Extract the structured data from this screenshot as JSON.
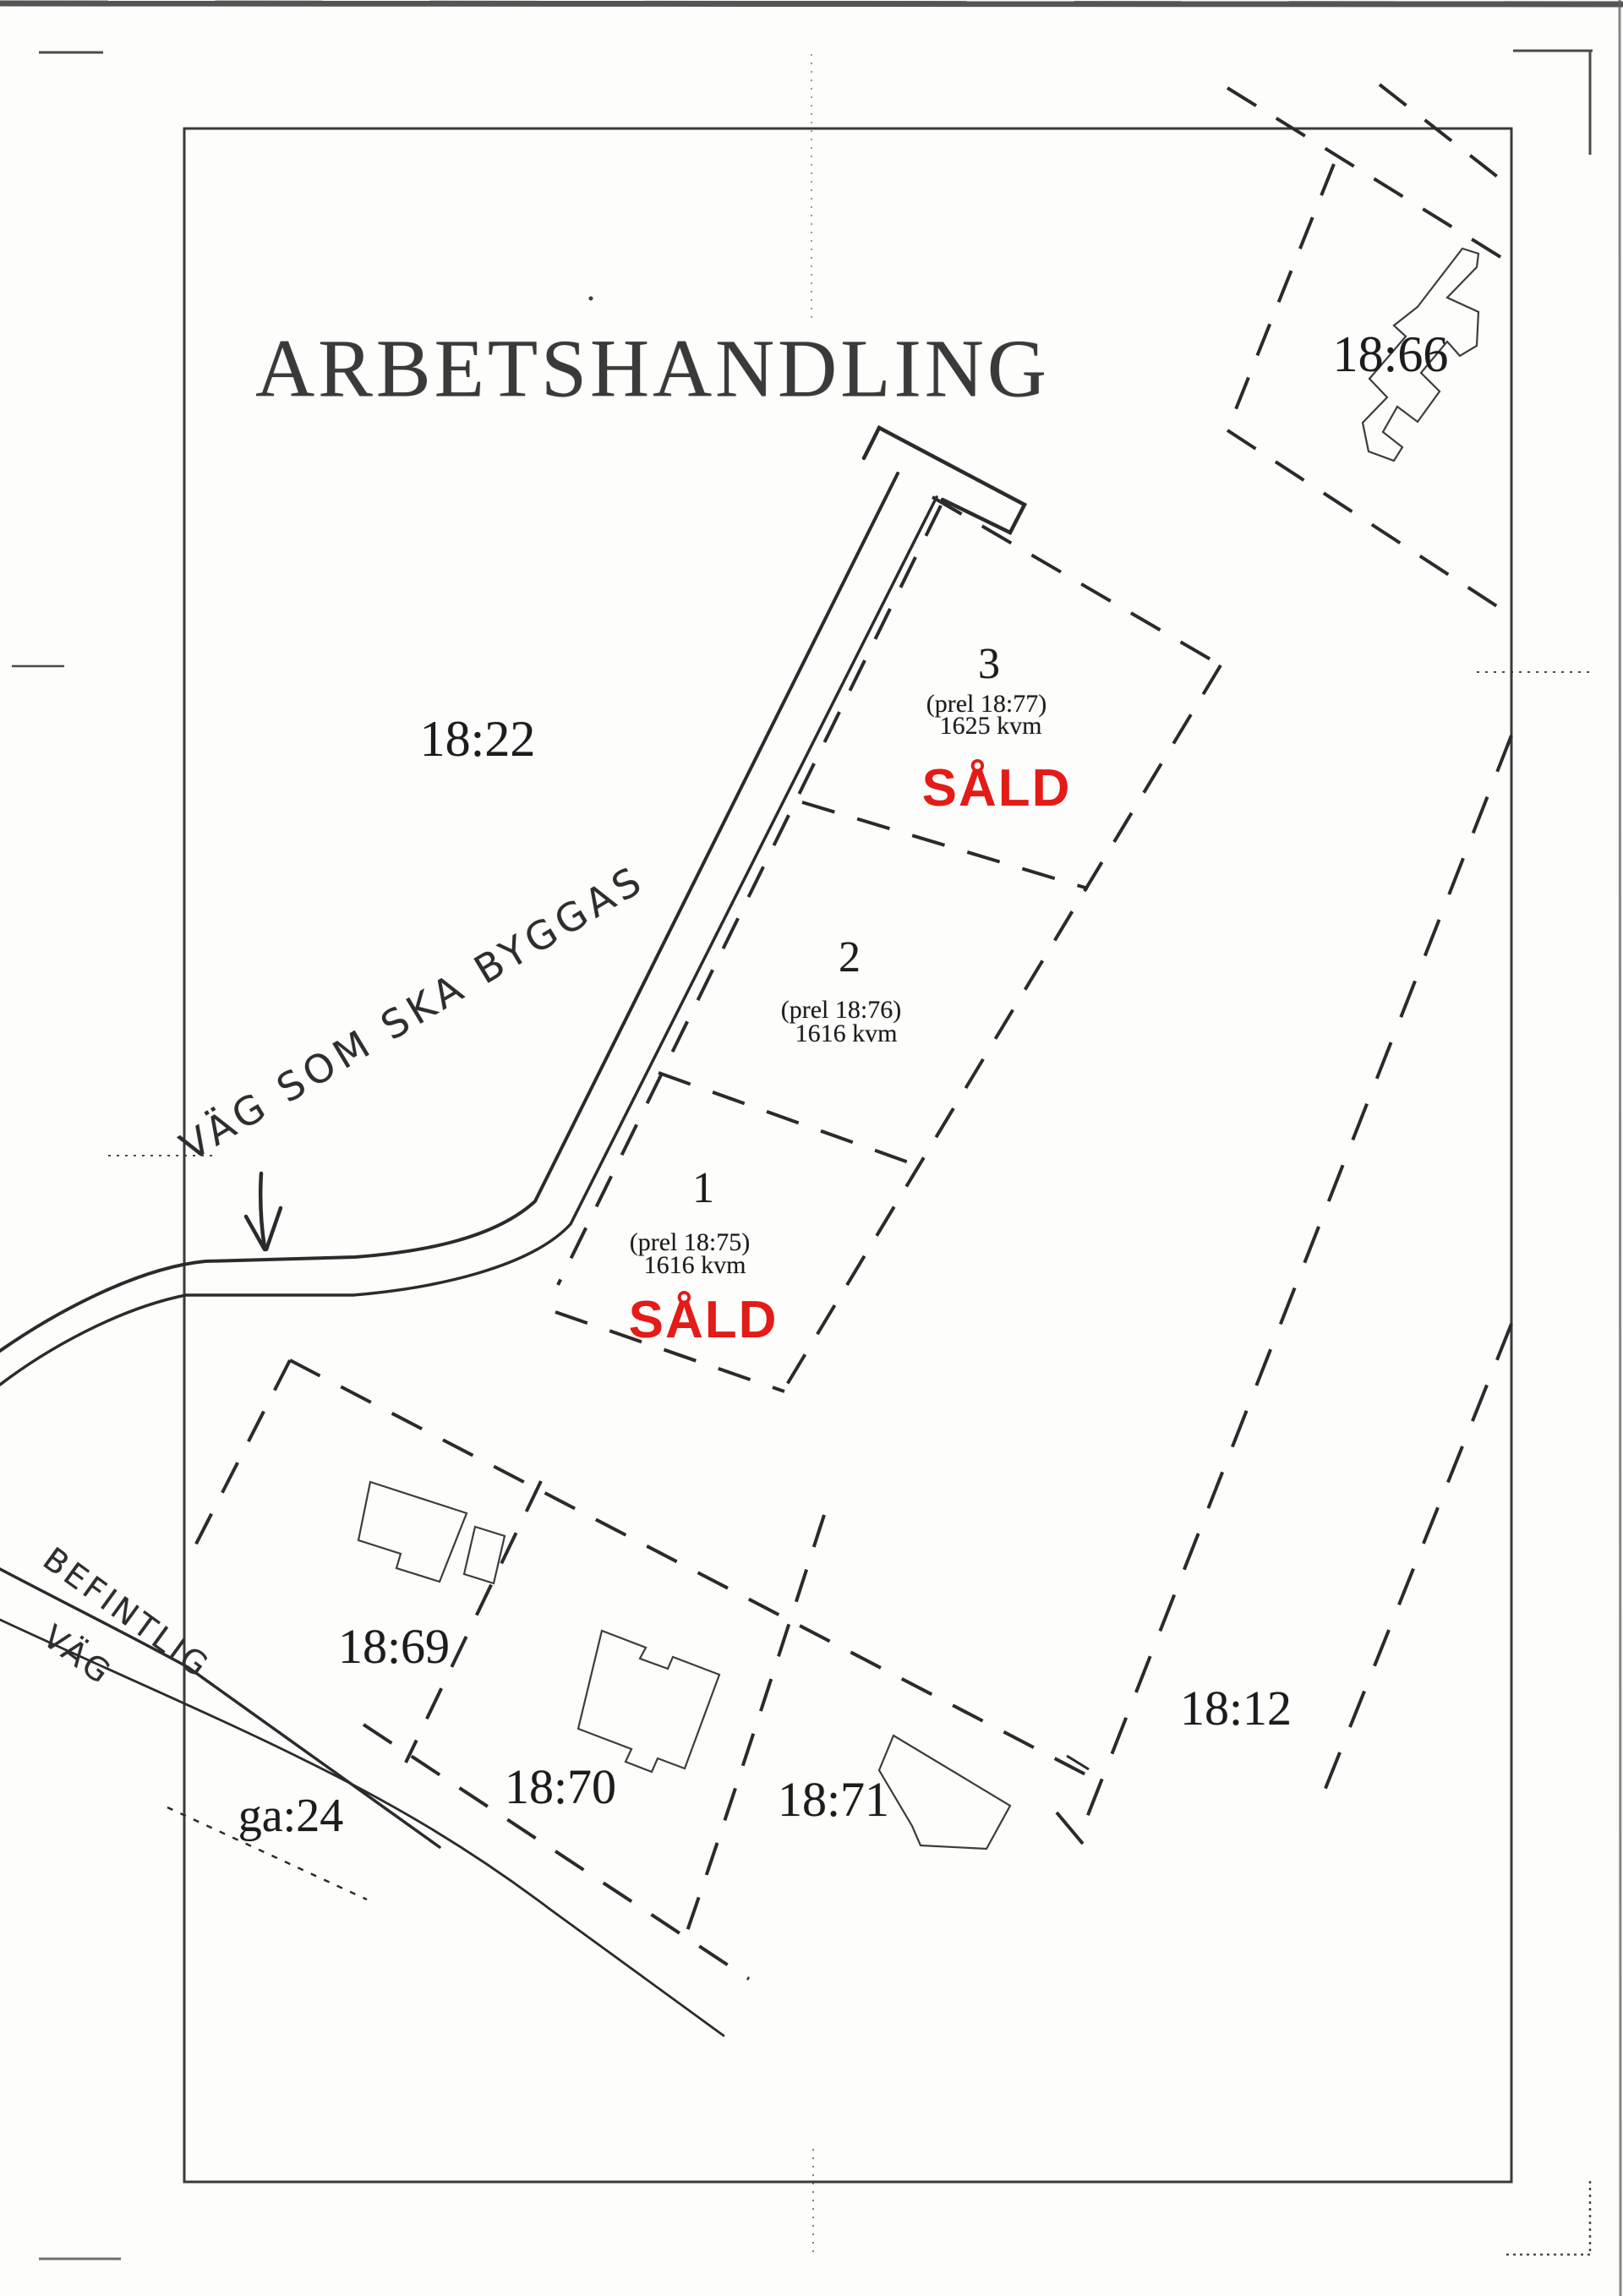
{
  "document": {
    "title": "ARBETSHANDLING"
  },
  "parcels": {
    "p18_22": {
      "label": "18:22"
    },
    "p18_66": {
      "label": "18:66"
    },
    "p18_69": {
      "label": "18:69"
    },
    "p18_70": {
      "label": "18:70"
    },
    "p18_71": {
      "label": "18:71"
    },
    "p18_12": {
      "label": "18:12"
    },
    "ga_24": {
      "label": "ga:24"
    }
  },
  "lots": {
    "lot3": {
      "number": "3",
      "prel": "(prel 18:77)",
      "area": "1625 kvm",
      "status": "SÅLD"
    },
    "lot2": {
      "number": "2",
      "prel": "(prel 18:76)",
      "area": "1616 kvm"
    },
    "lot1": {
      "number": "1",
      "prel": "(prel 18:75)",
      "area": "1616 kvm",
      "status": "SÅLD"
    }
  },
  "annotations": {
    "new_road": "VÄG SOM SKA BYGGAS",
    "existing_road_line1": "BEFINTLIG",
    "existing_road_line2": "VÄG"
  },
  "colors": {
    "sold_red": "#e41b17",
    "ink": "#2b2b2b"
  }
}
